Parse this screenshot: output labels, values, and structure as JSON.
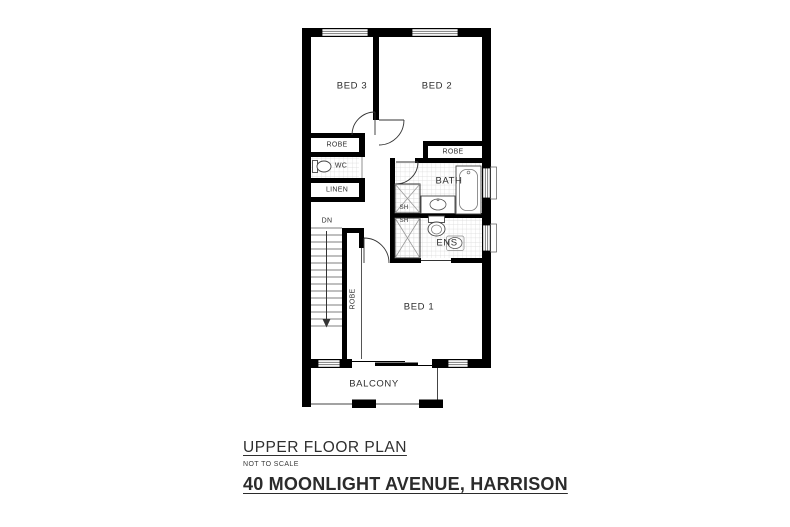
{
  "title_block": {
    "title": "UPPER FLOOR PLAN",
    "scale_note": "NOT TO SCALE",
    "address": "40 MOONLIGHT AVENUE, HARRISON"
  },
  "plan": {
    "rooms": {
      "bed1": "BED 1",
      "bed2": "BED 2",
      "bed3": "BED 3",
      "bath": "BATH",
      "ens": "ENS",
      "wc": "WC",
      "linen": "LINEN",
      "robe_bed3": "ROBE",
      "robe_bed2": "ROBE",
      "robe_bed1": "ROBE",
      "shower_bath": "SH",
      "shower_ens": "SH",
      "stairs_direction": "DN",
      "balcony": "BALCONY"
    }
  },
  "colors": {
    "background": "#ffffff",
    "wall": "#000000",
    "fixture_line": "#4a4a4a",
    "tile_line": "#d9d9d9",
    "text": "#2e2e2e"
  }
}
